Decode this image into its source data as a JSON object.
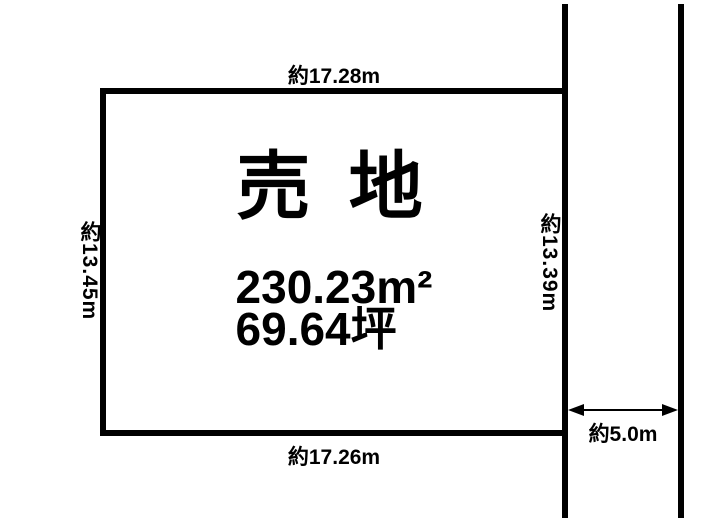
{
  "page": {
    "background_color": "#ffffff",
    "line_color": "#000000"
  },
  "plot": {
    "title": "売 地",
    "area_m2": "230.23m²",
    "area_tsubo": "69.64坪"
  },
  "dimensions": {
    "top": "約17.28m",
    "bottom": "約17.26m",
    "left": "約13.45m",
    "right": "約13.39m",
    "road_width": "約5.0m"
  }
}
